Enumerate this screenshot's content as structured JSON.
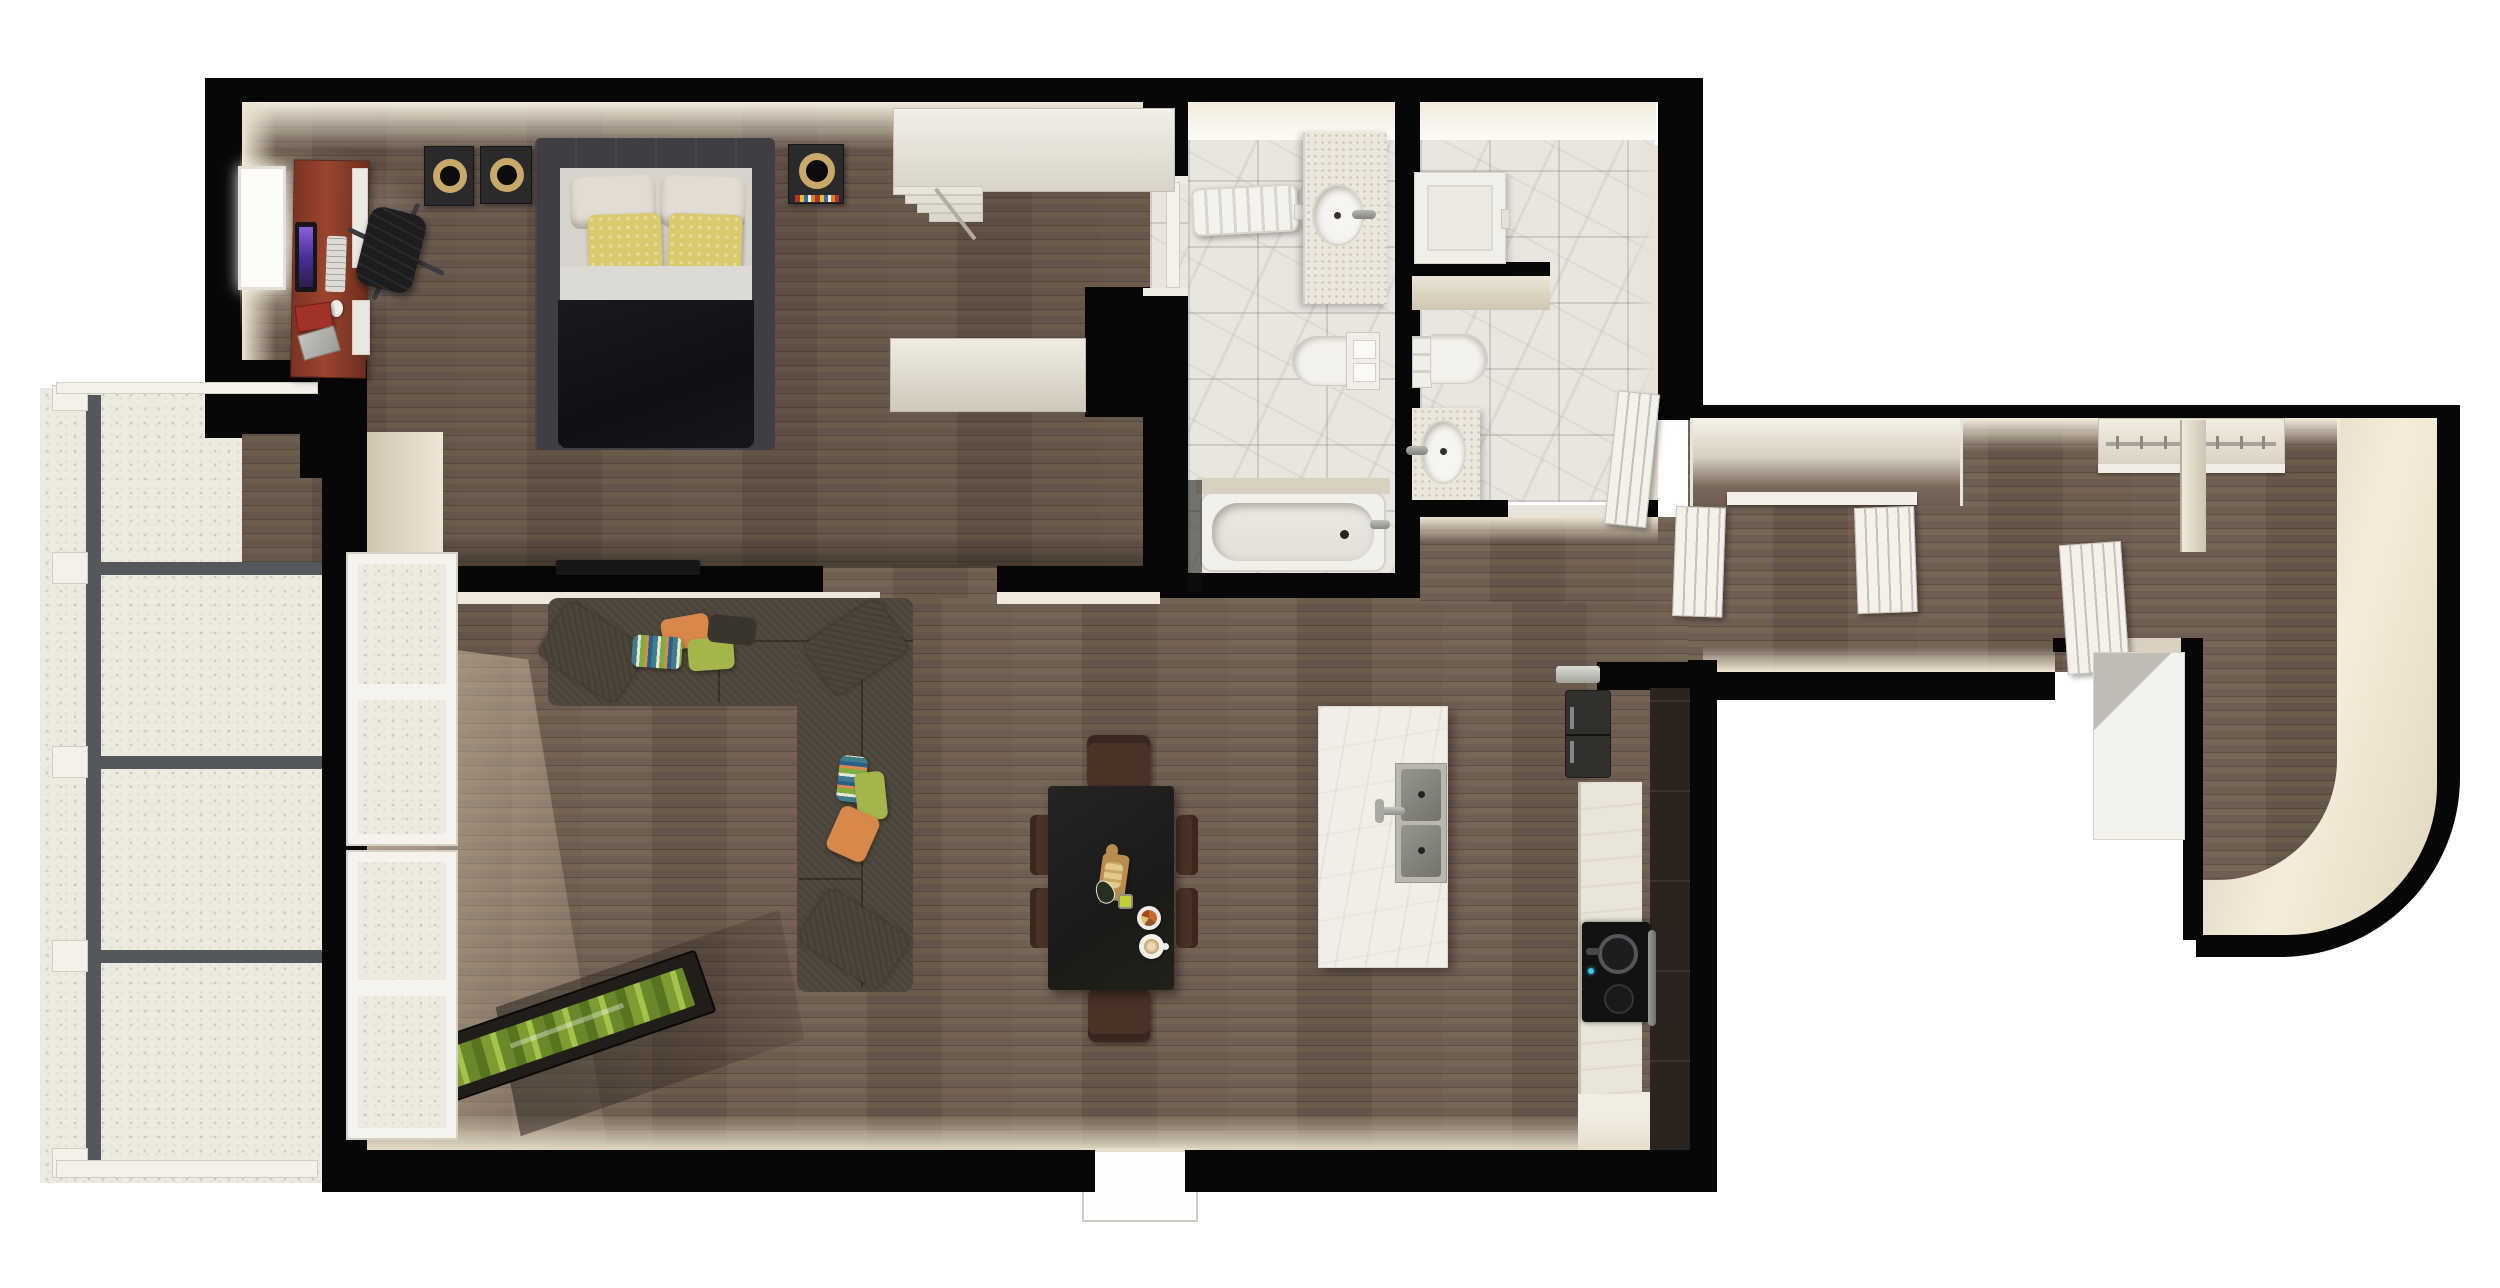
{
  "meta": {
    "type": "3d-floor-plan-render",
    "view": "top-down",
    "units": "none"
  },
  "palette": {
    "wall": "#070707",
    "wood": "#6b5c50",
    "marble": "#e9e6e0",
    "concrete": "#edeadf",
    "beigeLit": "#f0e9da",
    "fixtureWhite": "#f3f1ea",
    "sofa": "#4b4438",
    "pillowGreen": "#a5b54c",
    "pillowOrange": "#d7884a",
    "pillowYellow": "#d9ca6e",
    "bedDuvet": "#141418",
    "bedFrame": "#3e3e43",
    "deskWood": "#8a3b28",
    "diningTable": "#201e1c",
    "diningChair": "#4a3227",
    "cabinetDark": "#2b241e",
    "counterLight": "#eae5d9",
    "islandMarble": "#f1eee7",
    "lampGold": "#c9a96a",
    "plantGreen": "#83a437",
    "railGray": "#54585c"
  },
  "rooms": {
    "bedroom": {
      "label": "Bedroom",
      "furniture": [
        "double-bed",
        "white-pillows",
        "yellow-pillows",
        "nightstand-speakers",
        "desk",
        "monitor",
        "keyboard",
        "mouse",
        "books",
        "laptop",
        "office-chair",
        "window"
      ]
    },
    "closetHall": {
      "label": "Closet hall",
      "furniture": [
        "wardrobe-unit",
        "dresser-unit",
        "step-shelves"
      ]
    },
    "bathroom1": {
      "label": "Bathroom 1",
      "furniture": [
        "radiator",
        "vanity-round-sink",
        "toilet-with-cistern",
        "bathtub"
      ]
    },
    "bathroom2": {
      "label": "Bathroom 2",
      "furniture": [
        "shower-tray",
        "toilet",
        "vanity-oval-sink",
        "swing-door"
      ]
    },
    "living": {
      "label": "Living room",
      "furniture": [
        "sectional-sofa",
        "throw-pillows",
        "wall-tv",
        "planter-box",
        "tall-windows"
      ]
    },
    "dining": {
      "label": "Dining area",
      "furniture": [
        "dining-table",
        "six-chairs",
        "cutting-board",
        "plate",
        "coffee-cup",
        "small-dishes"
      ]
    },
    "kitchen": {
      "label": "Kitchen",
      "furniture": [
        "island-with-double-sink",
        "fridge",
        "cooktop-with-pot",
        "oven",
        "tall-cabinets",
        "counter",
        "pantry-floor"
      ]
    },
    "hallway": {
      "label": "Hallway",
      "furniture": [
        "closet-recess",
        "open-closet-doors",
        "wardrobe-rod-with-hangers"
      ]
    },
    "entry": {
      "label": "Entry",
      "furniture": [
        "entry-door",
        "white-cabinet",
        "curved-wall"
      ]
    },
    "balcony": {
      "label": "Balcony",
      "furniture": [
        "metal-railing",
        "concrete-deck",
        "white-posts"
      ]
    }
  }
}
